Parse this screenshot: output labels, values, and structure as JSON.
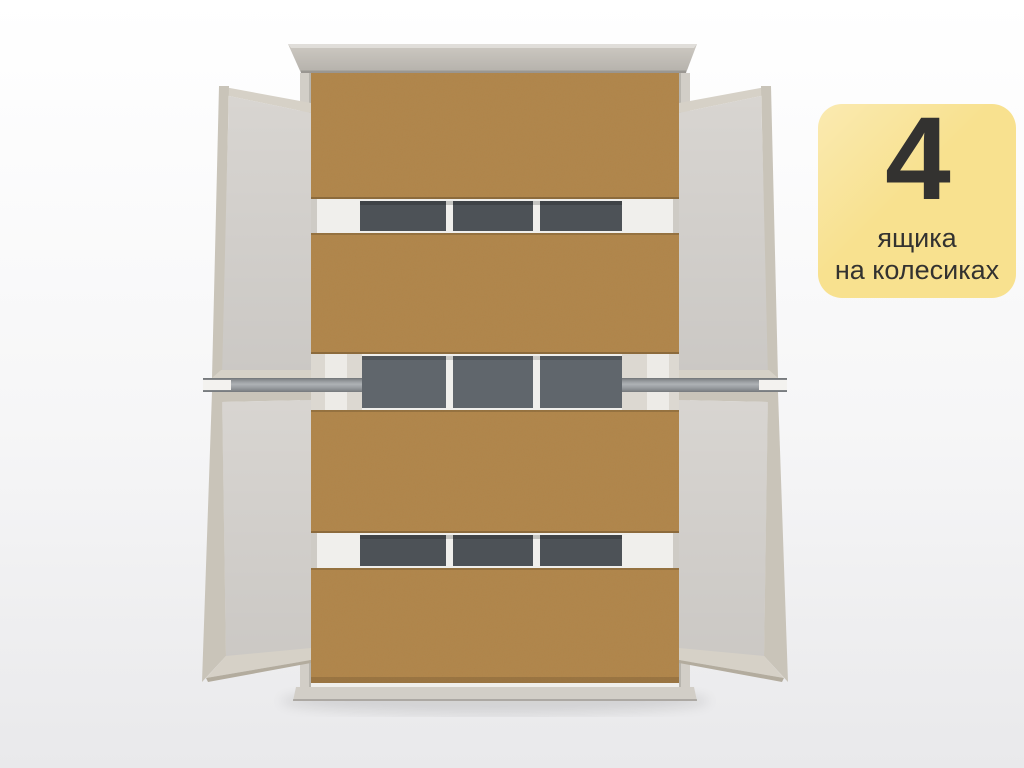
{
  "scene": {
    "kind": "furniture-product-render",
    "view": "top-down view of a bed frame with four pull-out storage drawers extended on both sides"
  },
  "badge": {
    "number": "4",
    "line1": "ящика",
    "line2": "на колесиках"
  },
  "colors": {
    "bg_top": "#ffffff",
    "bg_bottom": "#e9e9eb",
    "frame": "#d2cec7",
    "frame_dark": "#b7b3ab",
    "headboard": "#cdc9c2",
    "brown": "#b08449",
    "interior_bg": "#f0efec",
    "panel_gray": "#4d5257",
    "panel_gray_mid": "#60666c",
    "beige_block": "#dcd8d1",
    "white_inner": "#edebe7",
    "wood": "#c9c4b9",
    "wood_light": "#d6d1c7",
    "wood_dark": "#b3ac9e",
    "drawer_interior": "#d8d5d1",
    "rail_metal": "#9ba0a4",
    "notch_white": "#f3f2ef",
    "badge_bg": "#f8e18f",
    "badge_text": "#333230"
  }
}
